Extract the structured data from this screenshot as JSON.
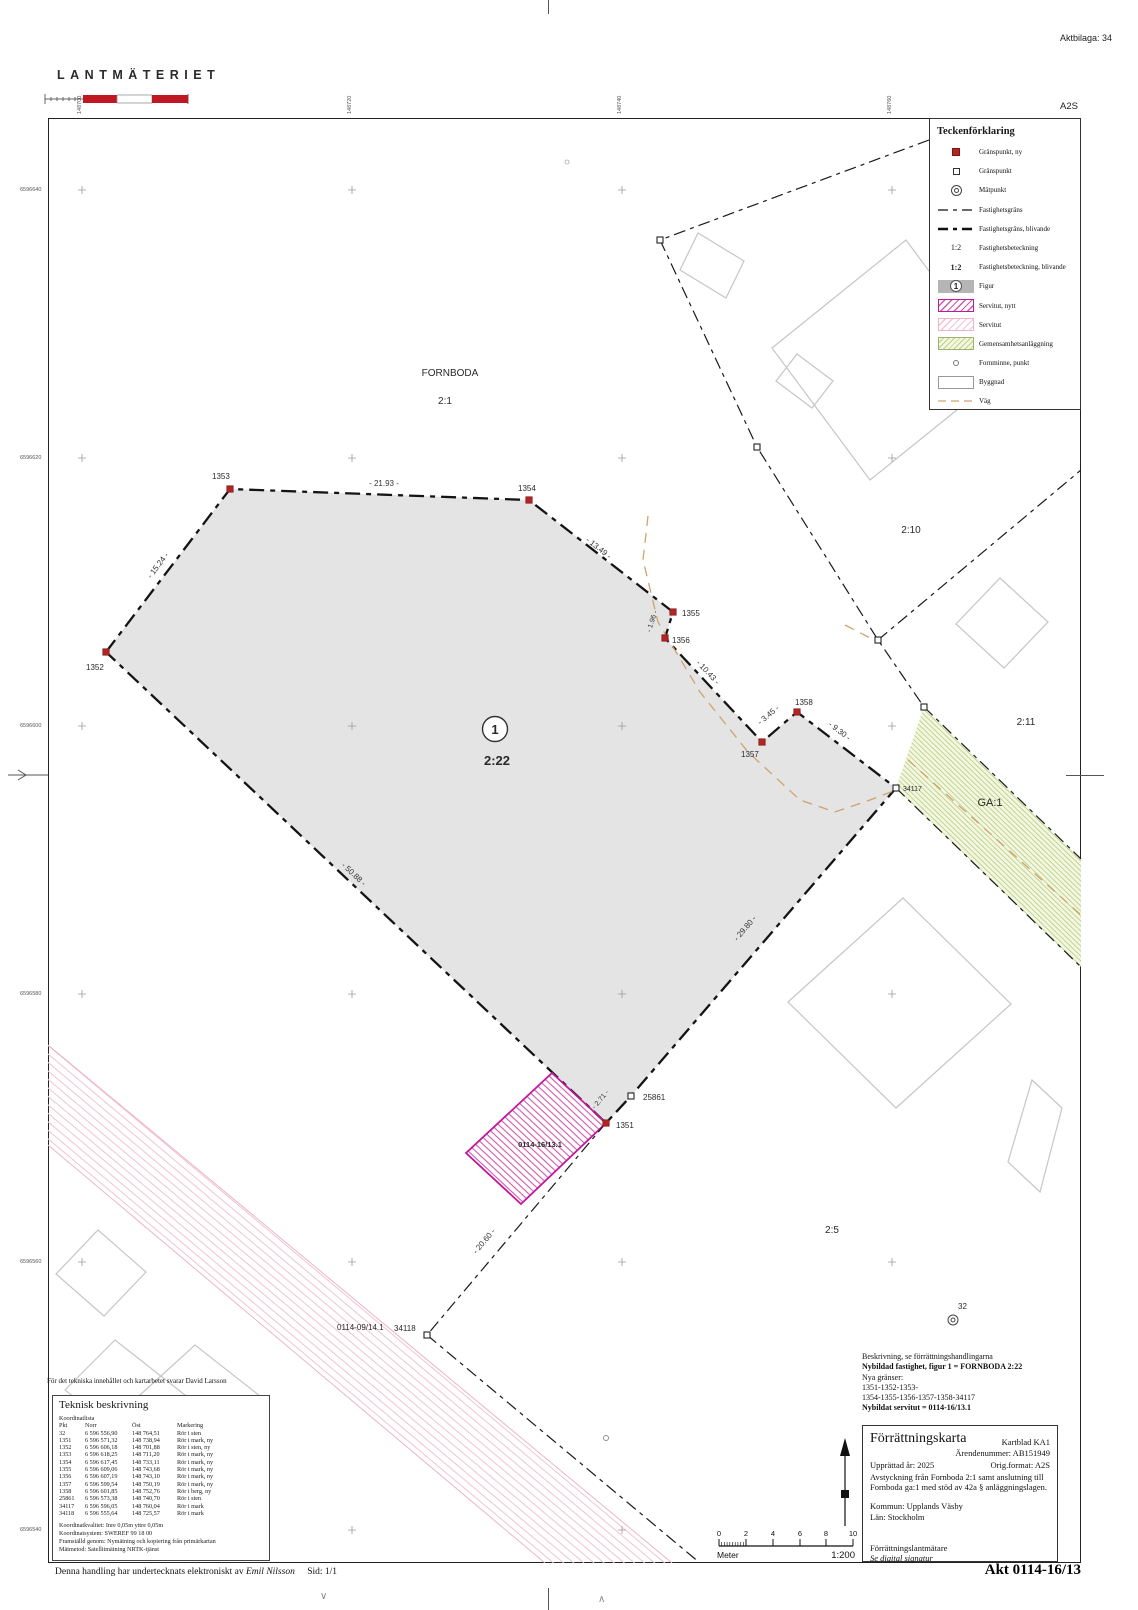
{
  "page": {
    "aktbilaga": "Aktbilaga: 34",
    "logo": "LANTMÄTERIET",
    "format_corner": "A2S",
    "tech_note": "För det tekniska innehållet och kartarbetet svarar David Larsson",
    "signature_line": "Denna handling har undertecknats elektroniskt av",
    "signer": "Emil Nilsson",
    "page_num": "Sid: 1/1",
    "akt_label": "Akt 0114-16/13"
  },
  "grid": {
    "eastings": [
      "148700",
      "148720",
      "148740",
      "148760"
    ],
    "northings": [
      "6596640",
      "6596620",
      "6596600",
      "6596580",
      "6596560",
      "6596540"
    ]
  },
  "legend": {
    "title": "Teckenförklaring",
    "sym_beteckning": "1:2",
    "sym_beteckning_ny": "1:2",
    "sym_figur": "1",
    "items": [
      {
        "label": "Gränspunkt, ny"
      },
      {
        "label": "Gränspunkt"
      },
      {
        "label": "Mätpunkt"
      },
      {
        "label": "Fastighetsgräns"
      },
      {
        "label": "Fastighetsgräns, blivande"
      },
      {
        "label": "Fastighetsbeteckning"
      },
      {
        "label": "Fastighetsbeteckning, blivande"
      },
      {
        "label": "Figur"
      },
      {
        "label": "Servitut, nytt"
      },
      {
        "label": "Servitut"
      },
      {
        "label": "Gemensamhetsanläggning"
      },
      {
        "label": "Fornminne, punkt"
      },
      {
        "label": "Byggnad"
      },
      {
        "label": "Väg"
      }
    ]
  },
  "map": {
    "labels": {
      "fornboda": "FORNBODA",
      "p21": "2:1",
      "p210": "2:10",
      "p211": "2:11",
      "ga1": "GA:1",
      "p25": "2:5",
      "p222": "2:22",
      "fig1": "1",
      "serv_new": "0114-16/13.1",
      "serv_old": "0114-09/14.1"
    },
    "points": [
      {
        "id": "1351"
      },
      {
        "id": "1352"
      },
      {
        "id": "1353"
      },
      {
        "id": "1354"
      },
      {
        "id": "1355"
      },
      {
        "id": "1356"
      },
      {
        "id": "1357"
      },
      {
        "id": "1358"
      },
      {
        "id": "25861"
      },
      {
        "id": "34117"
      },
      {
        "id": "34118"
      },
      {
        "id": "32"
      }
    ],
    "measurements": [
      "- 21.93 -",
      "- 15.24 -",
      "- 13.49 -",
      "- 1.96 -",
      "- 10.43 -",
      "- 3.45 -",
      "- 9.30 -",
      "- 29.80 -",
      "- 50.88 -",
      "- 2.71 -",
      "- 20.60 -"
    ]
  },
  "tech": {
    "title": "Teknisk beskrivning",
    "list_title": "Koordinatlista",
    "columns": [
      "Pkt",
      "Norr",
      "Öst",
      "Markering"
    ],
    "rows": [
      [
        "32",
        "6 596 556,90",
        "148 764,51",
        "Rör i sten"
      ],
      [
        "1351",
        "6 596 571,32",
        "148 738,94",
        "Rör i mark, ny"
      ],
      [
        "1352",
        "6 596 606,18",
        "148 701,88",
        "Rör i sten, ny"
      ],
      [
        "1353",
        "6 596 618,25",
        "148 711,20",
        "Rör i mark, ny"
      ],
      [
        "1354",
        "6 596 617,45",
        "148 733,11",
        "Rör i mark, ny"
      ],
      [
        "1355",
        "6 596 609,06",
        "148 743,68",
        "Rör i mark, ny"
      ],
      [
        "1356",
        "6 596 607,19",
        "148 743,10",
        "Rör i mark, ny"
      ],
      [
        "1357",
        "6 596 599,54",
        "148 750,19",
        "Rör i mark, ny"
      ],
      [
        "1358",
        "6 596 601,85",
        "148 752,76",
        "Rör i berg, ny"
      ],
      [
        "25861",
        "6 596 573,38",
        "148 740,70",
        "Rör i sten"
      ],
      [
        "34117",
        "6 596 596,05",
        "148 760,04",
        "Rör i mark"
      ],
      [
        "34118",
        "6 596 555,64",
        "148 725,57",
        "Rör i mark"
      ]
    ],
    "footer": [
      "Koordinatkvalitet: Inre 0,05m yttre 0,05m",
      "Koordinatsystem: SWEREF 99 18 00",
      "Framställd genom: Nymätning och kopiering från primärkartan",
      "Mätmetod: Satellitmätning NRTK-tjänst"
    ]
  },
  "beskrivning": {
    "l1": "Beskrivning, se förrättningshandlingarna",
    "l2": "Nybildad fastighet, figur 1 = FORNBODA 2:22",
    "l3": "Nya gränser:",
    "l4": "1351-1352-1353-",
    "l5": "1354-1355-1356-1357-1358-34117",
    "l6": "Nybildat servitut = 0114-16/13.1"
  },
  "titleblock": {
    "title": "Förrättningskarta",
    "kartblad": "Kartblad KA1",
    "arende": "Ärendenummer: AB151949",
    "upprattad": "Upprättad år: 2025",
    "origformat": "Orig.format: A2S",
    "desc1": "Avstyckning från Fornboda 2:1 samt anslutning till",
    "desc2": "Fornboda ga:1 med stöd av 42a § anläggningslagen.",
    "kommun": "Kommun: Upplands Väsby",
    "lan": "Län: Stockholm",
    "surveyor": "Förrättningslantmätare",
    "signature": "Se digital signatur"
  },
  "scalebar": {
    "ticks": [
      "0",
      "2",
      "4",
      "6",
      "8",
      "10"
    ],
    "unit": "Meter",
    "scale": "1:200"
  },
  "colors": {
    "point_new": "#b32424",
    "servitut_new": "#c2189c",
    "servitut_old": "#f3c3d2",
    "ga_fill": "#f3f7e2",
    "ga_hatch": "#bdd08a",
    "parcel_fill": "#e4e4e4",
    "road": "#cda36f",
    "logo_red": "#c01823"
  }
}
